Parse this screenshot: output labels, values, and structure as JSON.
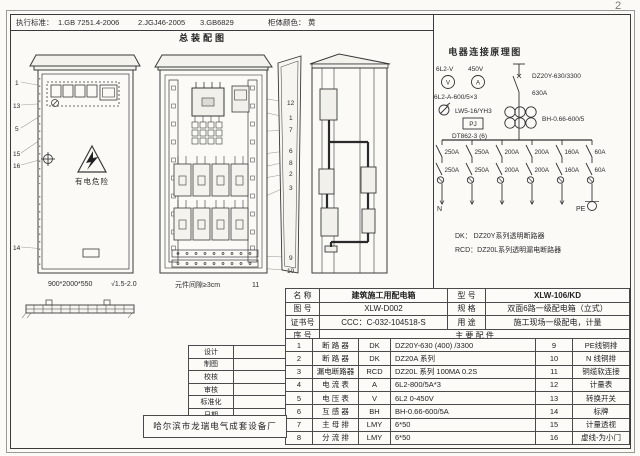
{
  "page_number": "2",
  "header": {
    "standards_label": "执行标准：",
    "standards": [
      "1.GB 7251.4-2006",
      "2.JGJ46-2005",
      "3.GB6829"
    ],
    "color_label": "柜体颜色：",
    "color_value": "黄"
  },
  "assembly": {
    "title": "总装配图",
    "front_view": {
      "callouts": [
        "1",
        "13",
        "5",
        "15",
        "16",
        "14"
      ],
      "warning_text": "有电危险",
      "dimensions": "900*2000*550",
      "plate_spec": "√1.5-2.0"
    },
    "internal_view": {
      "callouts": [
        "12",
        "1",
        "7",
        "6",
        "8",
        "2",
        "3",
        "9",
        "10"
      ],
      "caption": "元件间隙≥3cm",
      "caption_no": "11"
    }
  },
  "schematic": {
    "title": "电器连接原理图",
    "voltmeter_label": "6L2-V",
    "voltage": "450V",
    "meter_v": "V",
    "meter_a": "A",
    "ammeter_label": "6L2-A-600/5×3",
    "switch_label": "LW5-16/YH3",
    "pj_label": "PJ",
    "energy_meter_model": "DT862-3 (6)",
    "main_breaker_model": "DZ20Y-630/3300",
    "main_breaker_rating": "630A",
    "ct_label": "BH-0.66-600/5",
    "branches": [
      {
        "breaker1": "250A",
        "breaker2": "250A"
      },
      {
        "breaker1": "250A",
        "breaker2": "250A"
      },
      {
        "breaker1": "200A",
        "breaker2": "200A"
      },
      {
        "breaker1": "200A",
        "breaker2": "200A"
      },
      {
        "breaker1": "160A",
        "breaker2": "160A"
      },
      {
        "breaker1": "60A",
        "breaker2": "60A"
      }
    ],
    "neutral_label": "N",
    "pe_label": "PE",
    "legend": [
      "DK：  DZ20Y系列透明断路器",
      "RCD：DZ20L系列透明漏电断路器"
    ]
  },
  "info_table": {
    "rows": [
      {
        "label1": "名  称",
        "value1": "建筑施工用配电箱",
        "label2": "型  号",
        "value2": "XLW-106/KD"
      },
      {
        "label1": "图  号",
        "value1": "XLW-D002",
        "label2": "规  格",
        "value2": "双面6路一级配电箱（立式）"
      },
      {
        "label1": "证书号",
        "value1": "CCC：C-032-104518-S",
        "label2": "用  途",
        "value2": "施工现场一级配电，计量"
      }
    ],
    "seq_label": "序  号",
    "parts_header": "主 要 配 件"
  },
  "parts_table": {
    "rows": [
      {
        "no": "1",
        "name": "断 路 器",
        "code": "DK",
        "spec": "DZ20Y-630 (400) /3300",
        "no2": "9",
        "name2": "PE线铜排"
      },
      {
        "no": "2",
        "name": "断 路 器",
        "code": "DK",
        "spec": "DZ20A 系列",
        "no2": "10",
        "name2": "N 线铜排"
      },
      {
        "no": "3",
        "name": "漏电断路器",
        "code": "RCD",
        "spec": "DZ20L 系列 100MA 0.2S",
        "no2": "11",
        "name2": "铜缆软连接"
      },
      {
        "no": "4",
        "name": "电 流 表",
        "code": "A",
        "spec": "6L2-800/5A*3",
        "no2": "12",
        "name2": "计量表"
      },
      {
        "no": "5",
        "name": "电 压 表",
        "code": "V",
        "spec": "6L2 0-450V",
        "no2": "13",
        "name2": "转换开关"
      },
      {
        "no": "6",
        "name": "互 感 器",
        "code": "BH",
        "spec": "BH-0.66-600/5A",
        "no2": "14",
        "name2": "标牌"
      },
      {
        "no": "7",
        "name": "主 母 排",
        "code": "LMY",
        "spec": "6*50",
        "no2": "15",
        "name2": "计量透视"
      },
      {
        "no": "8",
        "name": "分 流 排",
        "code": "LMY",
        "spec": "6*50",
        "no2": "16",
        "name2": "虚线-为小门"
      }
    ]
  },
  "title_block": {
    "rows": [
      "设计",
      "制图",
      "校核",
      "审核",
      "标准化",
      "日期"
    ],
    "company": "哈尔滨市龙瑞电气成套设备厂"
  }
}
